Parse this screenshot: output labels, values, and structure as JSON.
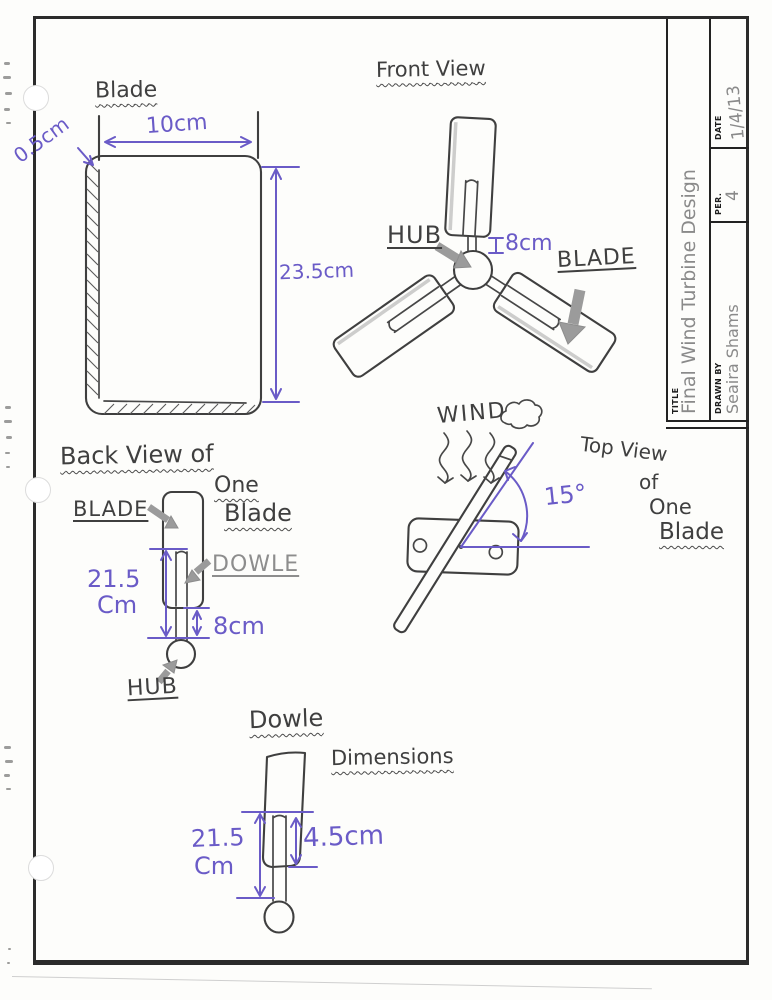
{
  "title_block": {
    "title_label": "TITLE",
    "title_value": "Final Wind Turbine Design",
    "drawn_by_label": "DRAWN BY",
    "drawn_by_value": "Seaira Shams",
    "per_label": "PER.",
    "per_value": "4",
    "date_label": "DATE",
    "date_value": "1/4/13"
  },
  "blade_detail": {
    "heading": "Blade",
    "width_dim": "10cm",
    "thickness_dim": "0.5cm",
    "height_dim": "23.5cm"
  },
  "front_view": {
    "heading": "Front View",
    "hub_label": "HUB",
    "blade_label": "BLADE",
    "dowel_exposed_dim": "8cm"
  },
  "back_view": {
    "heading_line1": "Back View of",
    "heading_line2": "One",
    "heading_line3": "Blade",
    "blade_label": "BLADE",
    "dowel_label": "DOWLE",
    "hub_label": "HUB",
    "dowel_length_value": "21.5",
    "dowel_length_unit": "Cm",
    "dowel_exposed_dim": "8cm"
  },
  "top_view": {
    "heading_word1": "Top View",
    "heading_word2": "of",
    "heading_word3": "One",
    "heading_word4": "Blade",
    "wind_label": "WIND",
    "blade_angle": "15°"
  },
  "dowel_detail": {
    "heading_line1": "Dowle",
    "heading_line2": "Dimensions",
    "length_value": "21.5",
    "length_unit": "Cm",
    "embed_dim": "4.5cm"
  },
  "colors": {
    "pencil_ink": "#3f3f3f",
    "dimension_ink": "#6a5bc7",
    "annotation_arrow_gray": "#9b9b9b",
    "frame_border": "#2b2b2b"
  }
}
